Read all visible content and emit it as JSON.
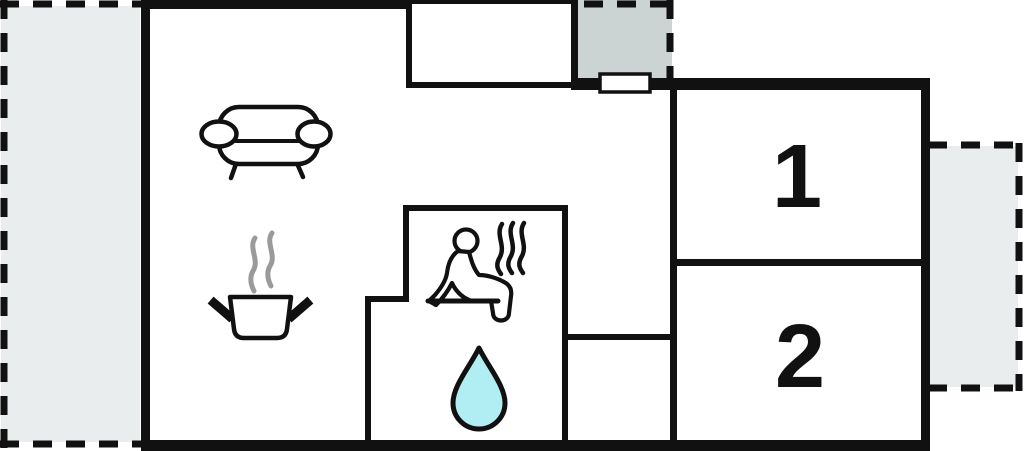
{
  "floor_plan": {
    "room_labels": {
      "room1": "1",
      "room2": "2"
    }
  },
  "icons": {
    "sofa": "sofa-icon",
    "cooking_pot": "cooking-pot-icon",
    "pot_steam": "pot-steam-icon",
    "sauna_person": "sauna-person-icon",
    "sauna_steam": "sauna-steam-icon",
    "water_drop": "water-drop-icon",
    "entrance_door": "entrance-door"
  },
  "colors": {
    "wall": "#111111",
    "background": "#ffffff",
    "terrace_fill": "#e9eded",
    "porch_fill": "#ccd3d3",
    "water_drop_fill": "#b0eef3",
    "steam_gray": "#9a9a9a",
    "icon_stroke": "#111111",
    "door_fill": "#ffffff"
  }
}
